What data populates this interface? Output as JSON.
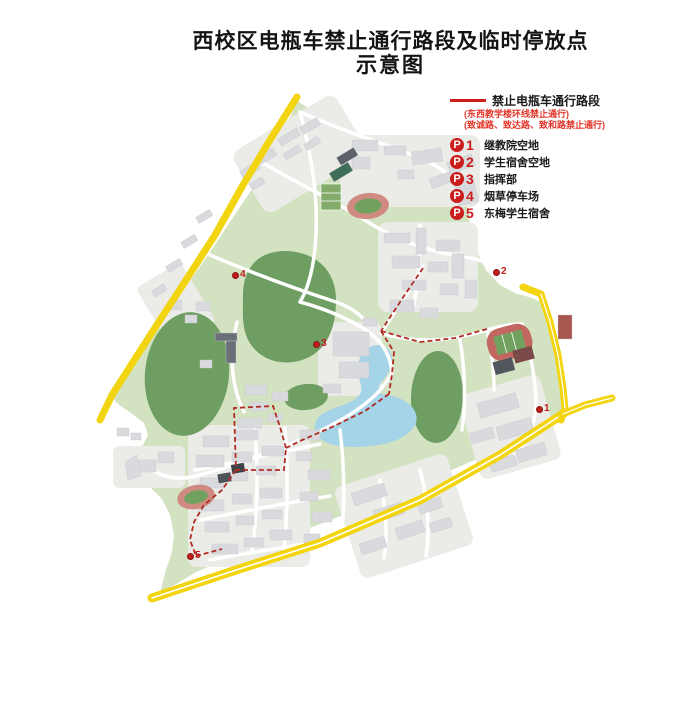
{
  "title": {
    "line1": "西校区电瓶车禁止通行路段及临时停放点",
    "line2": "示意图"
  },
  "legend": {
    "route_label": "禁止电瓶车通行路段",
    "route_note1": "(东西教学楼环线禁止通行)",
    "route_note2": "(致诚路、致达路、致和路禁止通行)",
    "badge_letter": "P",
    "items": [
      {
        "number": "1",
        "label": "继教院空地"
      },
      {
        "number": "2",
        "label": "学生宿舍空地"
      },
      {
        "number": "3",
        "label": "指挥部"
      },
      {
        "number": "4",
        "label": "烟草停车场"
      },
      {
        "number": "5",
        "label": "东梅学生宿舍"
      }
    ]
  },
  "map_markers": [
    {
      "id": "1",
      "x": 540,
      "y": 409
    },
    {
      "id": "2",
      "x": 497,
      "y": 272
    },
    {
      "id": "3",
      "x": 317,
      "y": 344
    },
    {
      "id": "4",
      "x": 236,
      "y": 275
    },
    {
      "id": "5",
      "x": 191,
      "y": 556
    }
  ],
  "colors": {
    "accent_red": "#cc1d1d",
    "route_dash_red": "#b02c24",
    "road_yellow": "#f2d411",
    "campus_green": "#d3e2c1",
    "hill_green": "#6e9e62",
    "lake_blue": "#a5d4e8",
    "building_gray": "#d9dade",
    "track_red": "#cf8b82",
    "field_green": "#70a15f",
    "court_dark": "#51565c"
  }
}
